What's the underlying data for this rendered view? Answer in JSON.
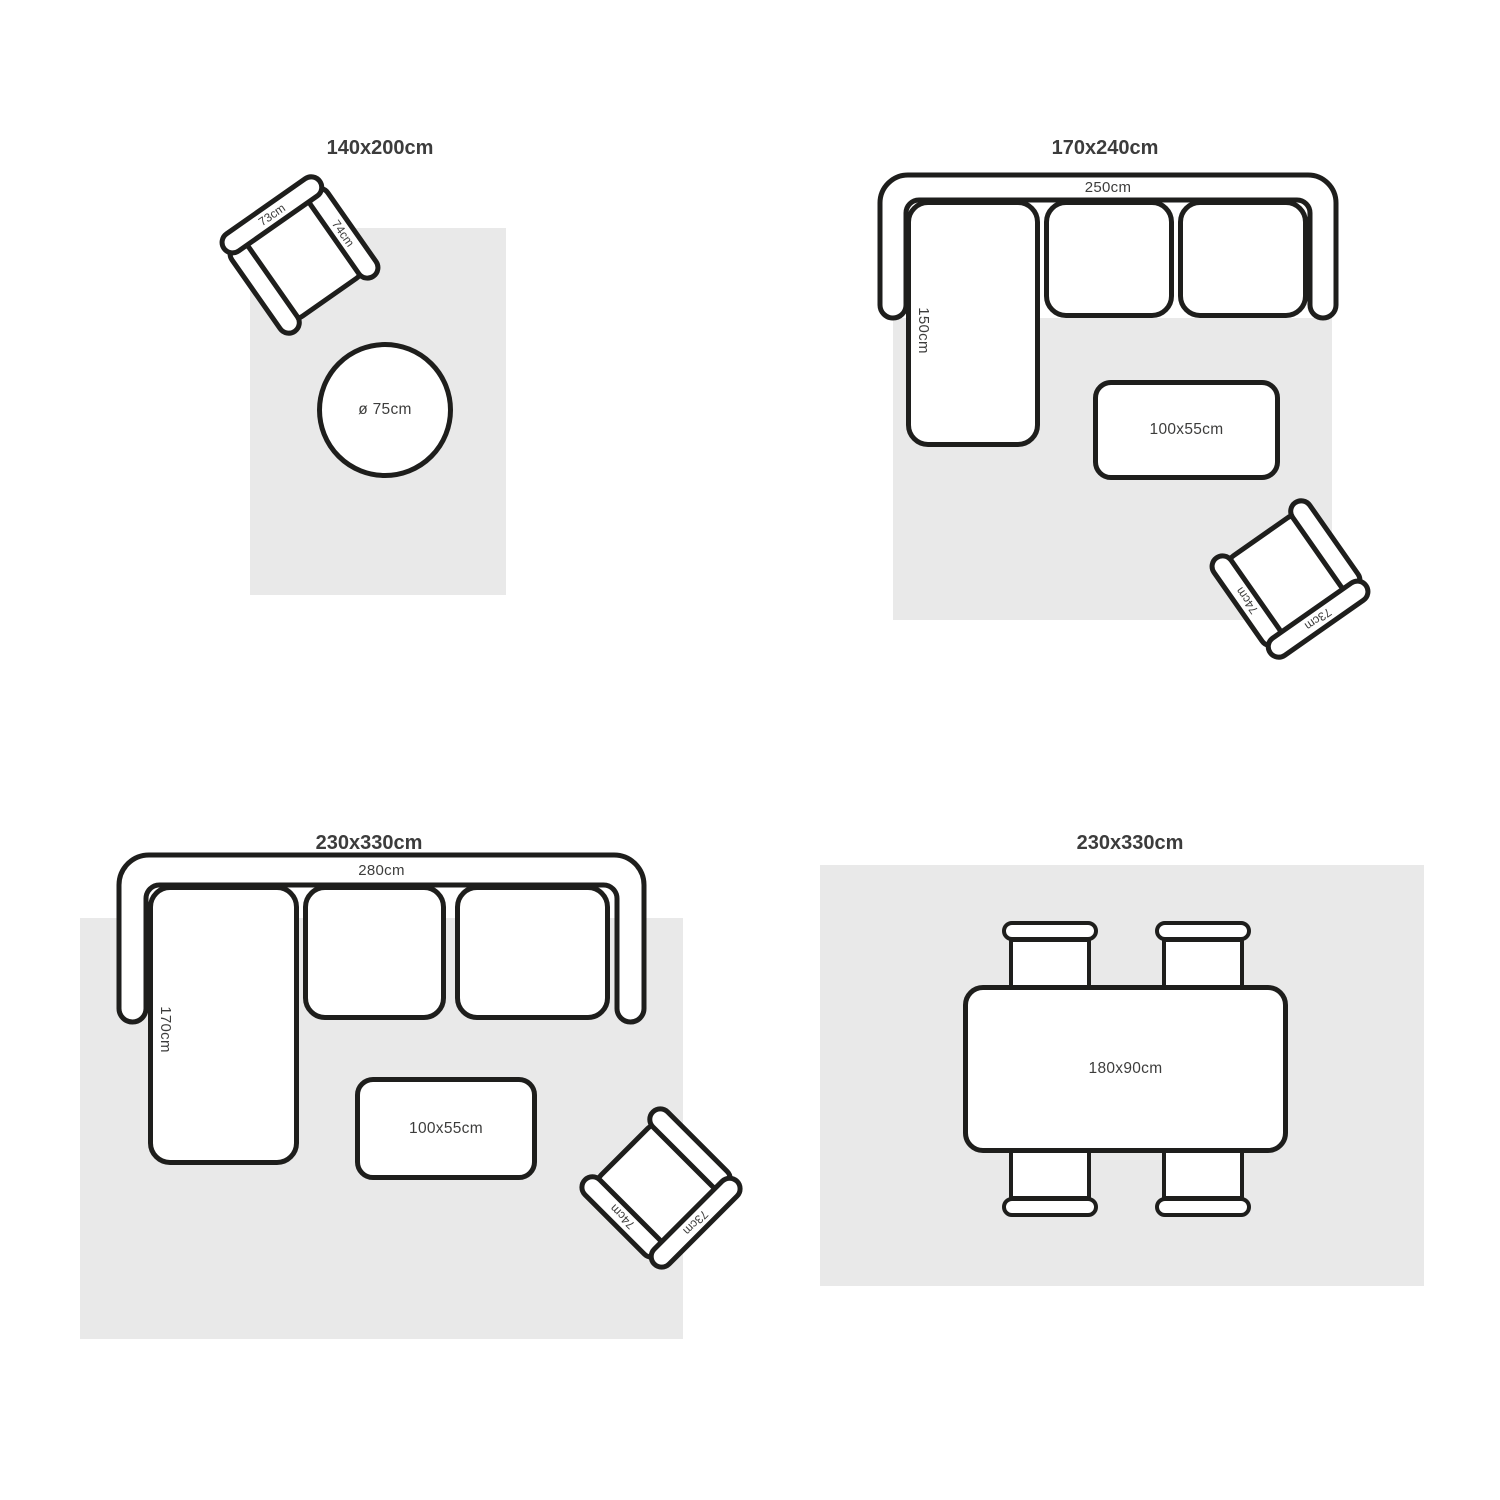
{
  "colors": {
    "stroke": "#1e1e1c",
    "rug_fill": "#e9e9e9",
    "title_text": "#3c3c3c",
    "label_text": "#3d3d3c",
    "furniture_fill": "#ffffff"
  },
  "panels": {
    "top_left": {
      "title": "140x200cm",
      "armchair": {
        "back_label": "73cm",
        "arm_label": "74cm"
      },
      "side_table": {
        "label": "ø 75cm"
      }
    },
    "top_right": {
      "title": "170x240cm",
      "sofa": {
        "width_label": "250cm",
        "depth_label": "150cm"
      },
      "coffee_table": {
        "label": "100x55cm"
      },
      "armchair": {
        "back_label": "73cm",
        "arm_label": "74cm"
      }
    },
    "bottom_left": {
      "title": "230x330cm",
      "sofa": {
        "width_label": "280cm",
        "depth_label": "170cm"
      },
      "coffee_table": {
        "label": "100x55cm"
      },
      "armchair": {
        "back_label": "73cm",
        "arm_label": "74cm"
      }
    },
    "bottom_right": {
      "title": "230x330cm",
      "dining_table": {
        "label": "180x90cm"
      }
    }
  }
}
